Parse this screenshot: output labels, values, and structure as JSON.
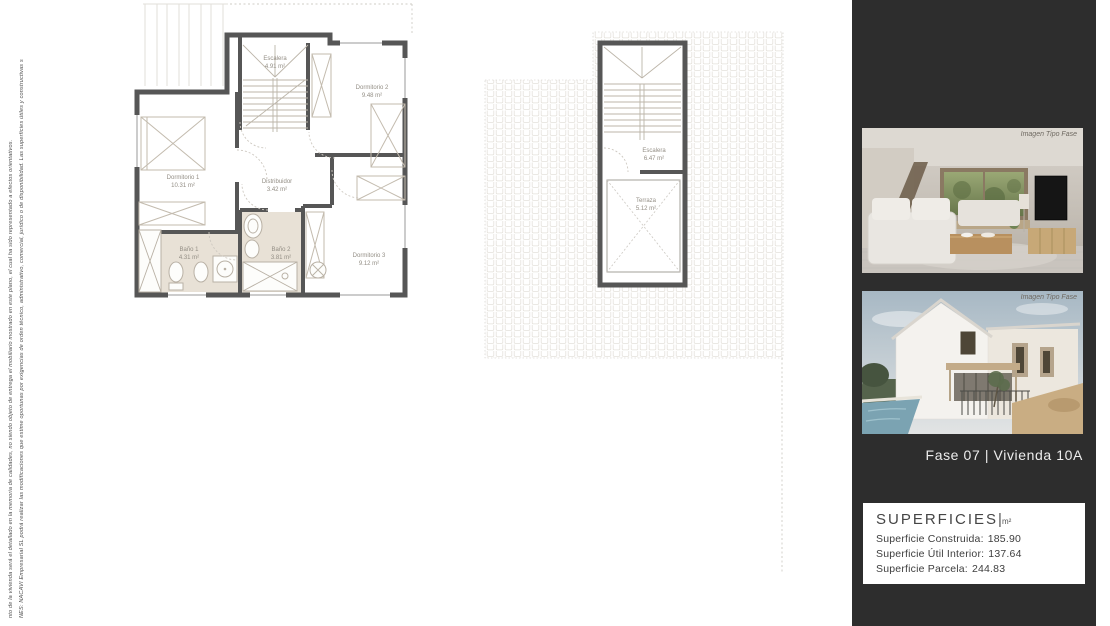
{
  "sheet": {
    "disclaimer_line_1": "NES: NACAVI Empresarial SL podrá realizar las modificaciones que estime oportunas por exigencias de orden técnico, administrativo, comercial, jurídico o de disponibilidad. Las superficies útiles y constructivas s",
    "disclaimer_line_2": "nto de la vivienda será el detallado en la memoria de calidades, no siendo objeto de entrega el mobiliario mostrado en este plano, el cual ha sido representado a efectos orientativos."
  },
  "floor_plan": {
    "rooms": {
      "escalera": {
        "name": "Escalera",
        "area": "4.91 m²"
      },
      "dormitorio2": {
        "name": "Dormitorio 2",
        "area": "9.48 m²"
      },
      "dormitorio1": {
        "name": "Dormitorio 1",
        "area": "10.31 m²"
      },
      "distribuidor": {
        "name": "Distribuidor",
        "area": "3.42 m²"
      },
      "bano1": {
        "name": "Baño 1",
        "area": "4.31 m²"
      },
      "bano2": {
        "name": "Baño 2",
        "area": "3.81 m²"
      },
      "dormitorio3": {
        "name": "Dormitorio 3",
        "area": "9.12 m²"
      }
    }
  },
  "roof_plan": {
    "rooms": {
      "escalera": {
        "name": "Escalera",
        "area": "6.47 m²"
      },
      "terraza": {
        "name": "Terraza",
        "area": "5.12 m²"
      }
    }
  },
  "sidebar": {
    "photo_caption": "Imagen Tipo Fase",
    "title": "Fase 07 |  Vivienda 10A",
    "superficies": {
      "heading": "SUPERFICIES",
      "separator": "|",
      "unit": "m²",
      "rows": [
        {
          "label": "Superficie Construida:",
          "value": "185.90"
        },
        {
          "label": "Superficie Útil Interior:",
          "value": "137.64"
        },
        {
          "label": "Superficie Parcela:",
          "value": "244.83"
        }
      ]
    }
  },
  "colors": {
    "sidebar_bg": "#2d2d2d",
    "wall": "#565656",
    "bath_floor": "#e8e1d6",
    "superficies_bg": "#ffffff",
    "title_text": "#ededed"
  }
}
